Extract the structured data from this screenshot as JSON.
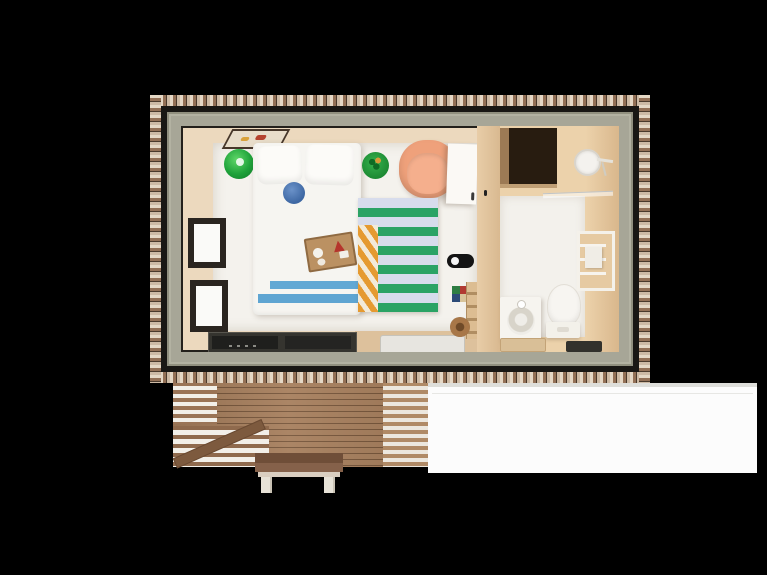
{
  "scene": {
    "description": "Top-down 3D render of a tiny cabin floor plan with a bedroom, a bathroom, a wooden slat deck and a small entry step on a black background",
    "background_color": "#000000"
  },
  "palette": {
    "shingle_light": "#e5d8c6",
    "shingle_brown": "#937056",
    "roof_edge_dark": "#191714",
    "weathered_wood_band": "#a7a697",
    "interior_wall_beige": "#ecd9be",
    "bedroom_floor_white": "#f4f2ed",
    "bathroom_wood_tan": "#e8cca5",
    "deck_plank_brown": "#a67e5c",
    "accent_green": "#1ea23a",
    "accent_orange_chair": "#efa17b",
    "rug_green": "#2ba365",
    "rug_lavender": "#d7dcec",
    "rug_edge_orange": "#e59a31",
    "blanket_blue": "#5fa5d2",
    "cushion_blue": "#4a77b8",
    "patio_white": "#fcfcfc"
  },
  "house": {
    "bedroom": {
      "items": [
        "wall-artwork",
        "green-pouf",
        "double-bed",
        "pillow-left",
        "pillow-right",
        "knit-cushion",
        "breakfast-tray",
        "plant-pot",
        "orange-armchair",
        "striped-rug",
        "foot-blanket",
        "window-upper",
        "window-lower",
        "sliding-glass-door",
        "entry-doormat",
        "wall-hook",
        "stacked-books",
        "towel-ladder",
        "round-basket",
        "open-door"
      ]
    },
    "bathroom": {
      "items": [
        "storage-niche",
        "shower-head",
        "glass-screen",
        "wall-towel-rack",
        "sink-vanity",
        "toilet",
        "floor-tray",
        "dark-bathmat"
      ]
    }
  },
  "exterior": {
    "items": [
      "wooden-deck",
      "deck-diagonal-plank",
      "entry-step",
      "white-patio"
    ]
  }
}
